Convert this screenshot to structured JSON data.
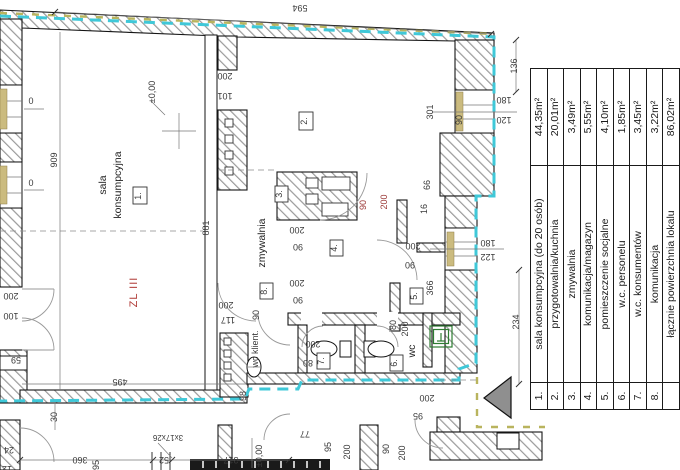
{
  "legend": {
    "rows": [
      {
        "no": "1.",
        "name": "sala konsumpcyjna (do 20 osób)",
        "area": "44,35m²"
      },
      {
        "no": "2.",
        "name": "przygotowalnia/kuchnia",
        "area": "20,01m²"
      },
      {
        "no": "3.",
        "name": "zmywalnia",
        "area": "3,49m²"
      },
      {
        "no": "4.",
        "name": "komunikacja/magazyn",
        "area": "5,55m²"
      },
      {
        "no": "5.",
        "name": "pomieszczenie socjalne",
        "area": "4,10m²"
      },
      {
        "no": "6.",
        "name": "w.c. personelu",
        "area": "1,85m²"
      },
      {
        "no": "7.",
        "name": "w.c. konsumentów",
        "area": "3,45m²"
      },
      {
        "no": "8.",
        "name": "komunikacja",
        "area": "3,22m²"
      },
      {
        "no": "",
        "name": "łącznie powierzchnia lokalu",
        "area": "86,02m²"
      }
    ]
  },
  "plan": {
    "rooms": {
      "n1": "1.",
      "n2": "2.",
      "n3": "3.",
      "n4": "4.",
      "n5": "5.",
      "n6": "6.",
      "n7": "7.",
      "n8": "8."
    },
    "labels": {
      "sala1": "sala",
      "sala2": "konsumpcyjna",
      "zmywalnia": "zmywalnia",
      "wc": "wc",
      "wc_klient": "wc klient.",
      "zl": "ZL III",
      "level": "±0,00",
      "level2": "±0,00",
      "stairs": "3x17x26"
    },
    "dims": {
      "d594": "594",
      "d136": "136",
      "d180a": "180",
      "d120": "120",
      "d301": "301",
      "d90a": "90",
      "d200a": "200",
      "d101": "101",
      "d909": "909",
      "d881": "881",
      "d66": "66",
      "d16": "16",
      "r90": "90",
      "r200": "200",
      "d200b": "200",
      "d90b": "90",
      "d200c": "200",
      "d90c": "90",
      "d200d": "200",
      "d90d": "90",
      "d366": "366",
      "d180b": "180",
      "d122": "122",
      "d234": "234",
      "d495": "495",
      "d200e": "200",
      "d117": "117",
      "d200f": "200",
      "d100": "100",
      "d59": "59",
      "d30": "30",
      "d360": "360",
      "d95a": "95",
      "d52": "52",
      "d317": "317",
      "d77": "77",
      "d95b": "95",
      "d200g": "200",
      "d90e": "90",
      "d200h": "200",
      "d200i": "200",
      "d80a": "80",
      "d80b": "80",
      "d200j": "200",
      "d200k": "200",
      "d95c": "95",
      "d98": "98",
      "d90f": "90",
      "d24": "24",
      "d12": "12",
      "d0a": "0",
      "d0b": "0"
    }
  },
  "colors": {
    "boundary_cyan": "#3fc8d8",
    "boundary_olive": "#b9b45e",
    "dim_red": "#9c3a38",
    "fire_label_red": "#b03a36",
    "window_sill": "#cbbb7f",
    "symbol_green": "#2e7d32"
  }
}
